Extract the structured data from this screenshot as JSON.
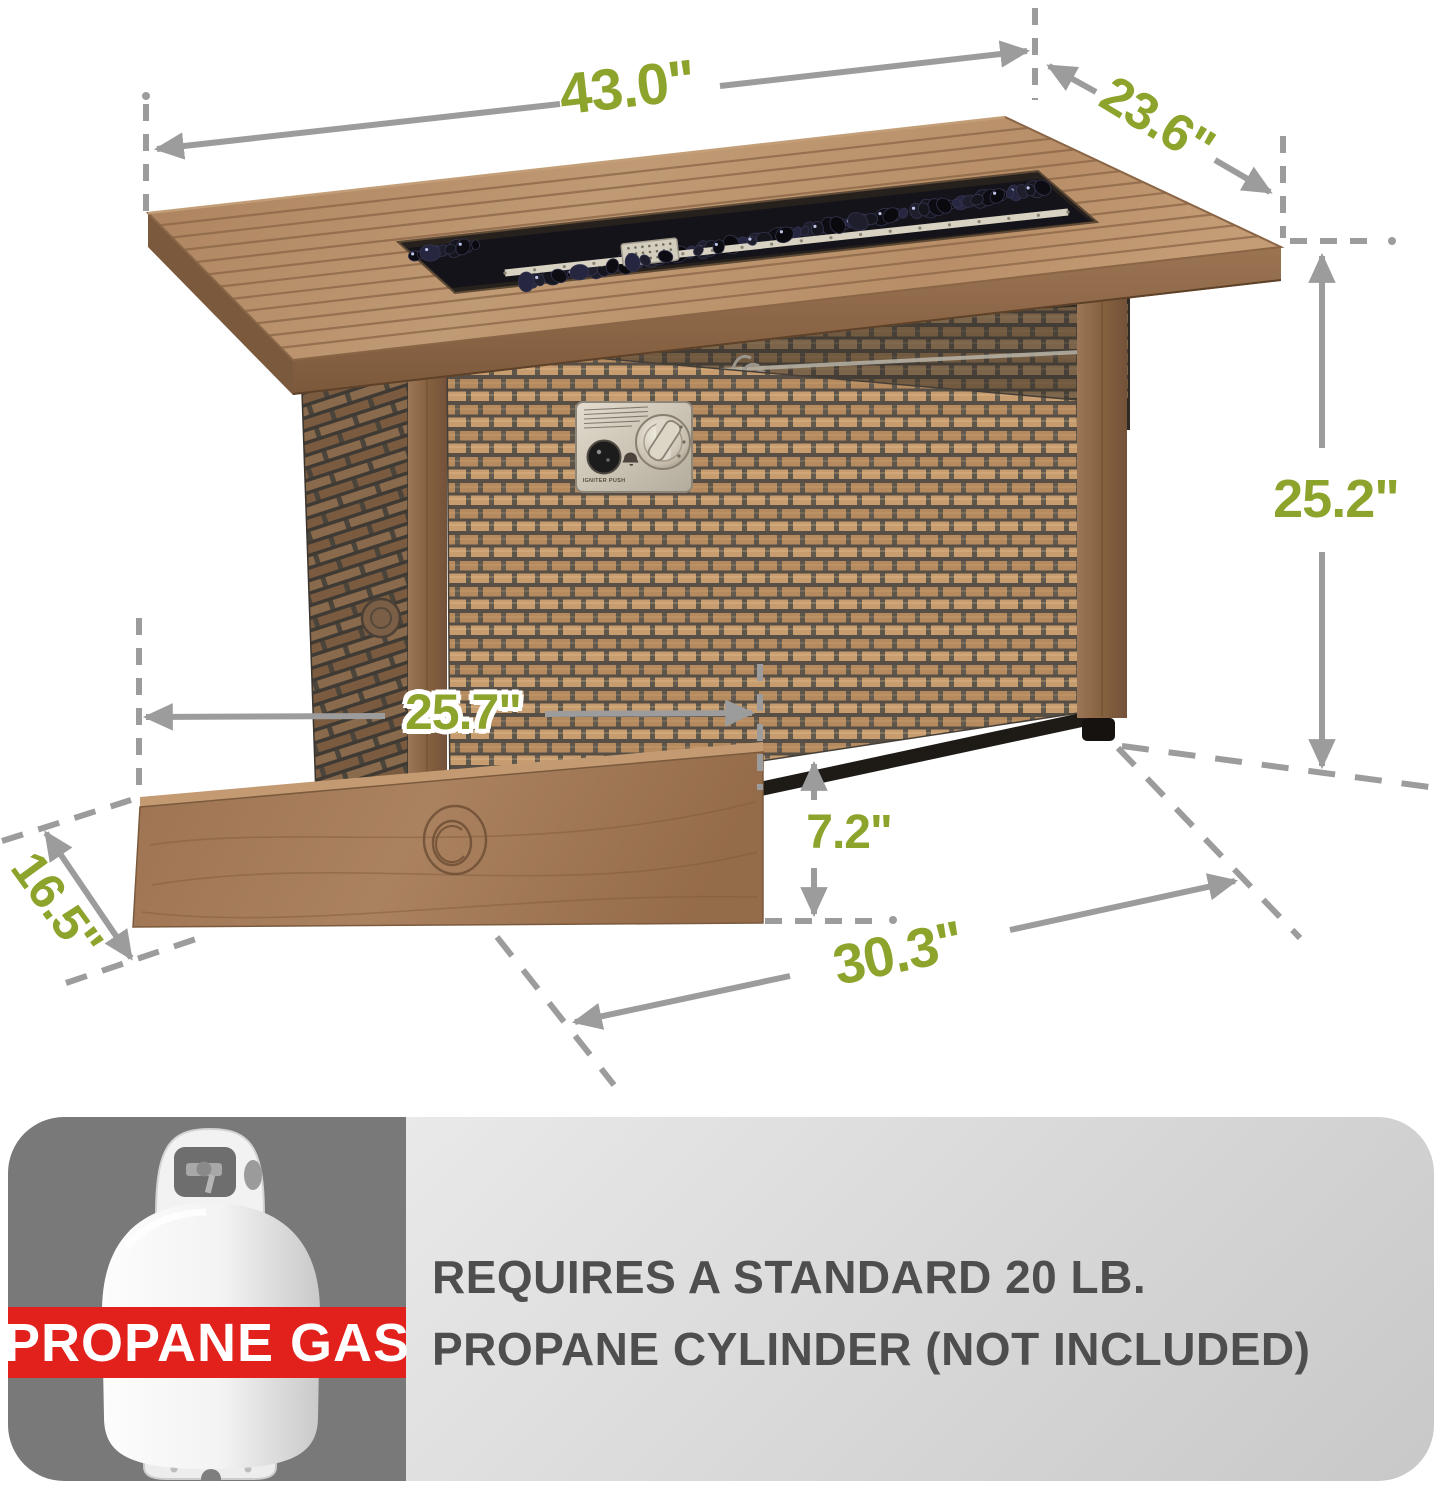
{
  "dimensions": {
    "top_length": {
      "label": "43.0\""
    },
    "top_depth": {
      "label": "23.6\""
    },
    "height": {
      "label": "25.2\""
    },
    "inner_width": {
      "label": "25.7\""
    },
    "ground_clearance": {
      "label": "7.2\""
    },
    "base_length": {
      "label": "30.3\""
    },
    "lid_depth": {
      "label": "16.5\""
    }
  },
  "control_panel": {
    "igniter_label": "IGNITER PUSH"
  },
  "banner": {
    "band_label": "PROPANE GAS",
    "note_line1": "REQUIRES A STANDARD 20 LB.",
    "note_line2": "PROPANE CYLINDER (NOT INCLUDED)"
  },
  "icons": {
    "propane_tank": "propane-tank-icon"
  },
  "colors": {
    "accent_green": "#8CA32C",
    "dim_gray": "#9C9C9C",
    "banner_red": "#E2211C",
    "banner_dark": "#797979",
    "banner_light_1": "#E9E9E9",
    "banner_light_2": "#C8C8C8",
    "note_text": "#4E4E4E"
  }
}
